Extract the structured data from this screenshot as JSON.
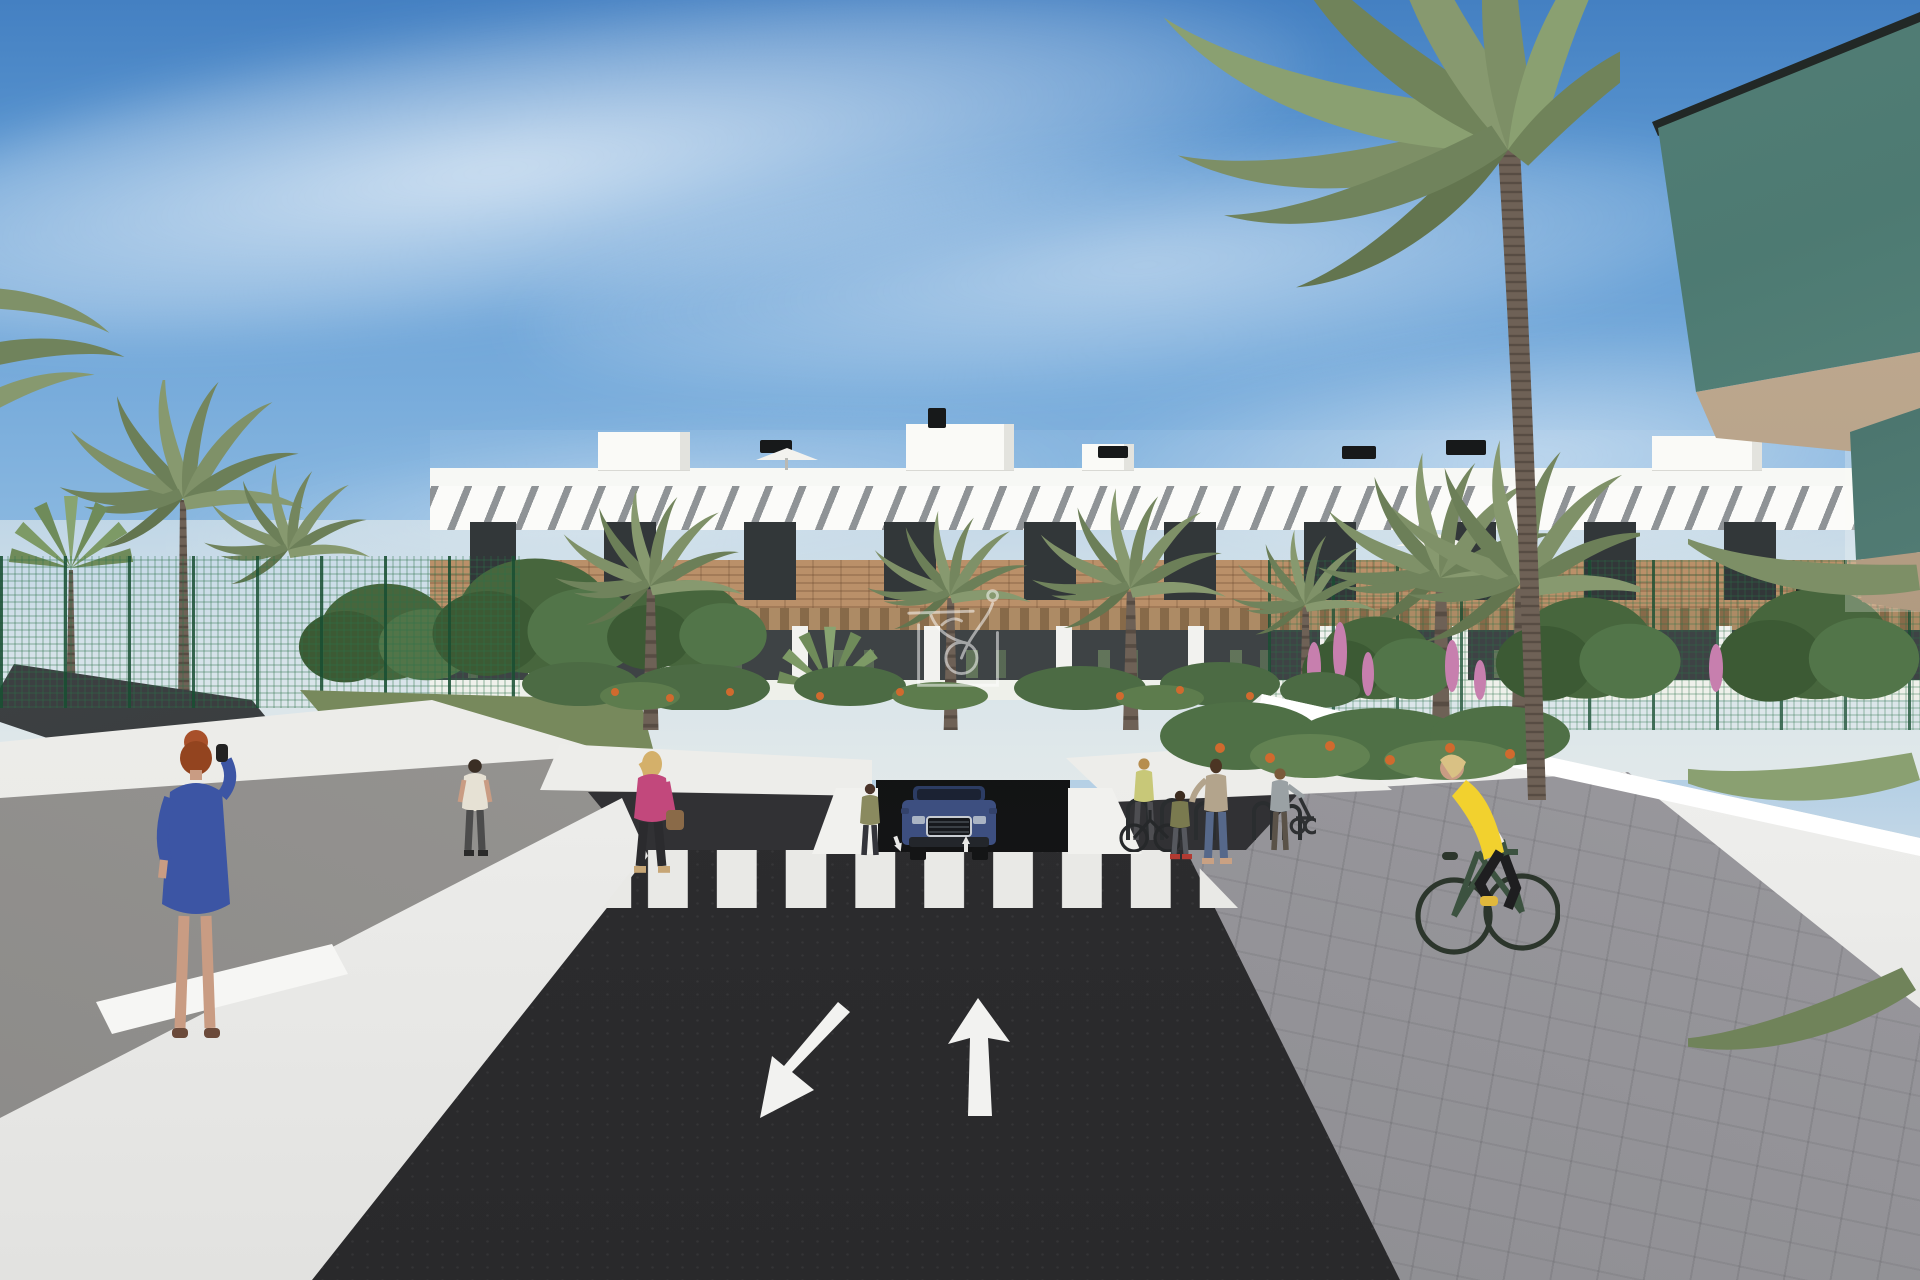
{
  "meta": {
    "title": "New-build residential complex - exterior street visualisation",
    "image_type": "3d-architectural-render"
  },
  "palette": {
    "sky_top": "#4480c2",
    "sky_horizon": "#e9ebe7",
    "building_white": "#f6f6f3",
    "louvre_shadow": "#878b8e",
    "wood_cladding": "#b5885e",
    "pergola_wood": "#8a673f",
    "window_glass": "#23282b",
    "balcony_glass_green": "#567e76",
    "asphalt": "#2e2e30",
    "road_marking": "#f2f2f0",
    "wall_white": "#eff0ec",
    "walkway_concrete": "#a3a19e",
    "pavers_grey": "#96969a",
    "fence_green": "#2e6b47",
    "shade_sail_grey": "#3a3e40",
    "palm_frond": "#7f9168",
    "tree_green": "#47663d",
    "flowers_orange": "#d06a2e",
    "flowers_pink": "#c77fae"
  },
  "scene": {
    "sky": {
      "label": "clear blue sky with thin cirrus clouds"
    },
    "watermark": {
      "label": "white line-art logo watermark",
      "color": "#ffffff",
      "opacity": 0.52
    },
    "building": {
      "label": "three-storey white apartment block with diagonal sun louvres, timber cladding band and ground-floor pergola terraces",
      "roof_label": "flat roofs with stair cores, black vents and white parasols"
    },
    "foreground_building": {
      "label": "near building corner with green glass balconies",
      "glass": "#567e76",
      "soffit": "#b9a58d"
    },
    "road": {
      "label": "two-way asphalt access road",
      "markings": {
        "color": "#f2f2f0",
        "left_arrow_direction": "towards viewer",
        "right_arrow_direction": "away from viewer",
        "crosswalk": "zebra crossing"
      },
      "garage_label": "underground car-park entrance ramp"
    },
    "vehicles": {
      "suv": {
        "label": "dark blue SUV leaving the car-park ramp",
        "body_color": "#3d4f80"
      }
    },
    "people": {
      "woman_phone": {
        "label": "red-haired woman in blue dress on the phone",
        "hair": "#a8502a",
        "dress": "#3c55a4",
        "skin": "#c99c83"
      },
      "man_walking": {
        "label": "man in beige t-shirt walking towards the complex",
        "shirt": "#e6e1d4",
        "trousers": "#4c4c4c"
      },
      "woman_pink": {
        "label": "blonde woman in pink jacket with handbag",
        "jacket": "#c2487c",
        "bag": "#8a6a48"
      },
      "woman_by_car": {
        "label": "woman standing beside the garage ramp",
        "top": "#8a8a5f"
      },
      "woman_with_bike": {
        "label": "woman wheeling a bicycle",
        "top": "#c8c878"
      },
      "mother": {
        "label": "mother resting a hand on child's head",
        "top": "#b3a48c",
        "jeans": "#56688a"
      },
      "child": {
        "label": "child in olive top",
        "top": "#7a7a4f",
        "shoes": "#b23a32"
      },
      "woman_stroller": {
        "label": "woman with stroller by the planting bed",
        "top": "#9aa1a4"
      },
      "cyclist": {
        "label": "blonde woman cycling in yellow gilet",
        "vest_color": "#f2d12e",
        "sleeves": "#f0ece4",
        "leggings": "#1e1e20",
        "bike": "#3c5240",
        "shoes": "#e0b83c"
      }
    },
    "street_furniture": {
      "bike_racks": {
        "label": "black hoop bicycle stands",
        "color": "#2a2d2f"
      }
    },
    "vegetation": {
      "palms_label": "date palms and fan palms lining the street",
      "trees_label": "green broadleaf trees",
      "shade_sail_label": "dark grey shade sail over sports court",
      "fence_label": "green mesh sports fencing",
      "flowers_orange": "#d06a2e",
      "flowers_pink": "#c77fae"
    }
  }
}
